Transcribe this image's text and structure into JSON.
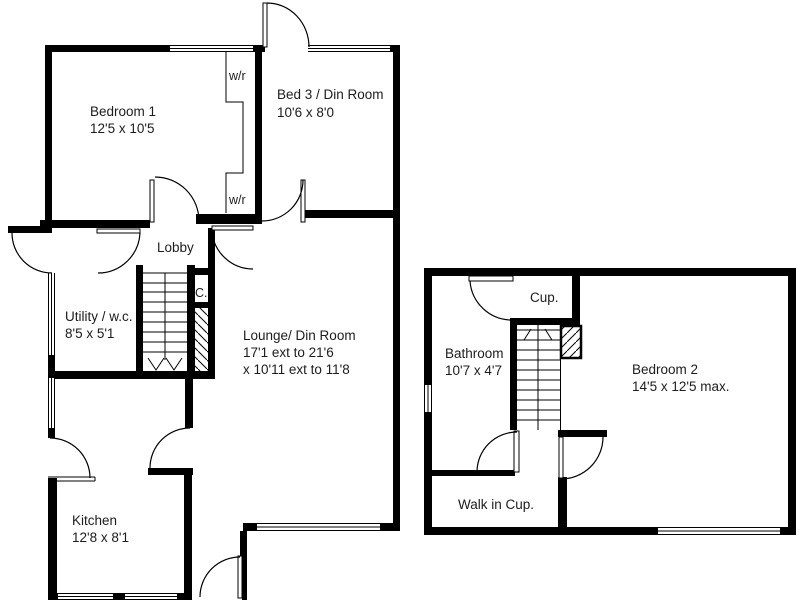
{
  "floor_plan": {
    "background": "#ffffff",
    "wall_color": "#000000",
    "text_color": "#1c1c1c",
    "ground_floor": {
      "rooms": [
        {
          "name": "Bedroom 1",
          "dims": "12'5 x 10'5"
        },
        {
          "name": "Bed 3 / Din Room",
          "dims": "10'6 x 8'0"
        },
        {
          "name": "Lobby"
        },
        {
          "name": "Utility / w.c.",
          "dims": "8'5 x 5'1"
        },
        {
          "name": "Lounge/ Din Room",
          "dims": "17'1 ext to 21'6",
          "dims2": "x 10'11 ext to 11'8"
        },
        {
          "name": "Kitchen",
          "dims": "12'8 x 8'1"
        }
      ],
      "closet_labels": {
        "wardrobe": "w/r",
        "cupboard": "C."
      }
    },
    "first_floor": {
      "rooms": [
        {
          "name": "Cup."
        },
        {
          "name": "Bathroom",
          "dims": "10'7 x 4'7"
        },
        {
          "name": "Bedroom 2",
          "dims": "14'5 x 12'5 max."
        },
        {
          "name": "Walk in Cup."
        }
      ]
    }
  }
}
